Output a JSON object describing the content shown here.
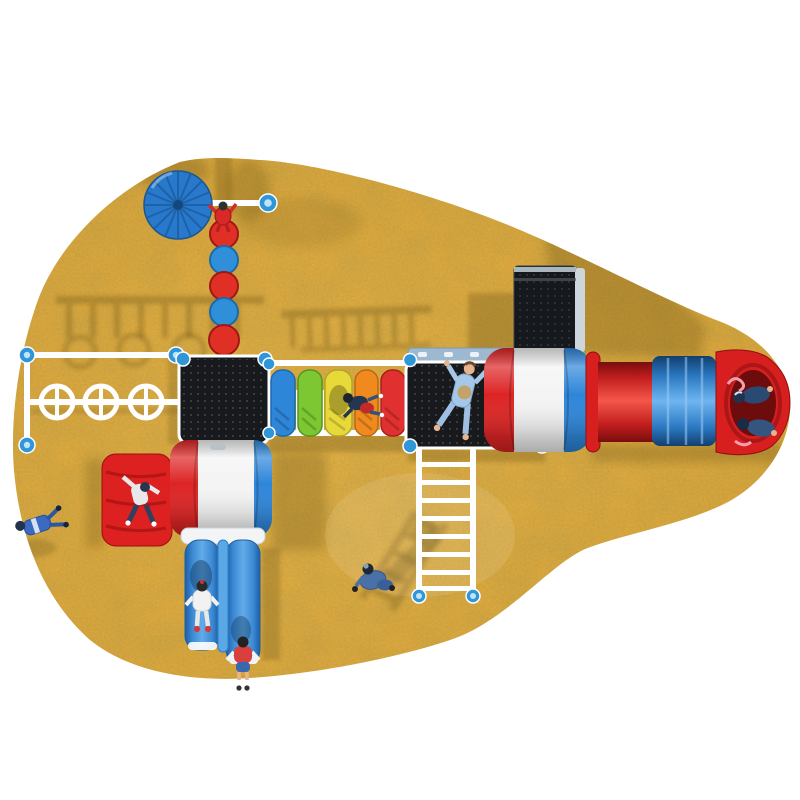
{
  "scene": {
    "type": "3d-render-top-view",
    "subject": "outdoor-children-playground-on-sand-patch",
    "objects": [
      "sand-area",
      "sun-umbrella",
      "overhead-spinner-wheels-frame",
      "disc-climber-pole",
      "left-play-deck",
      "rainbow-crawl-bridge",
      "right-play-deck",
      "climbing-wall-panel",
      "round-tower",
      "crawl-tube-slide",
      "tube-slide-exit",
      "vertical-ladder",
      "red-rock-climber",
      "barrel-tower",
      "double-wave-slide",
      "children-figures"
    ]
  },
  "colors": {
    "background": "#FFFFFF",
    "sand_base": "#E2A93C",
    "sand_mottle": "#7A5A14",
    "shadow": "#6B5213",
    "white": "#FFFFFF",
    "cap_blue": "#2F96D8",
    "cap_blue_light": "#BFE3F7",
    "umbrella_blue": "#2878CC",
    "umbrella_rib": "#1D62A8",
    "disc_red": "#E03026",
    "disc_blue": "#2F8FD8",
    "platform_black": "#17191C",
    "platform_dot": "#9AA0A6",
    "platform_top_band": "#9DB9CF",
    "paddle_blue": "#2E86D9",
    "paddle_green": "#7DC832",
    "paddle_yellow": "#E8D93A",
    "paddle_orange": "#F08A1E",
    "paddle_red": "#E03030",
    "tower_red": "#DD2424",
    "tower_white": "#F4F4F4",
    "tower_blue": "#2E86D9",
    "tube_red": "#C21E1E",
    "tube_blue": "#2A77C0",
    "tube_exit_red": "#D81F1F",
    "tube_mouth": "#6D0C0C",
    "slide_blue": "#3C8AD4",
    "slide_divider": "#5AA9E6",
    "climber_red": "#DD2020",
    "ladder_white": "#FFFFFF",
    "wall_black": "#15181C",
    "wall_edge": "#CDD6DC",
    "skin": "#E8B48E",
    "kid_navy": "#2A4A74",
    "kid_white": "#F2F2F2",
    "kid_red": "#D84040",
    "kid_denim": "#4A70A8",
    "kid_lightblue": "#A6C8E8",
    "scarf_pink": "#F0A0B0"
  }
}
